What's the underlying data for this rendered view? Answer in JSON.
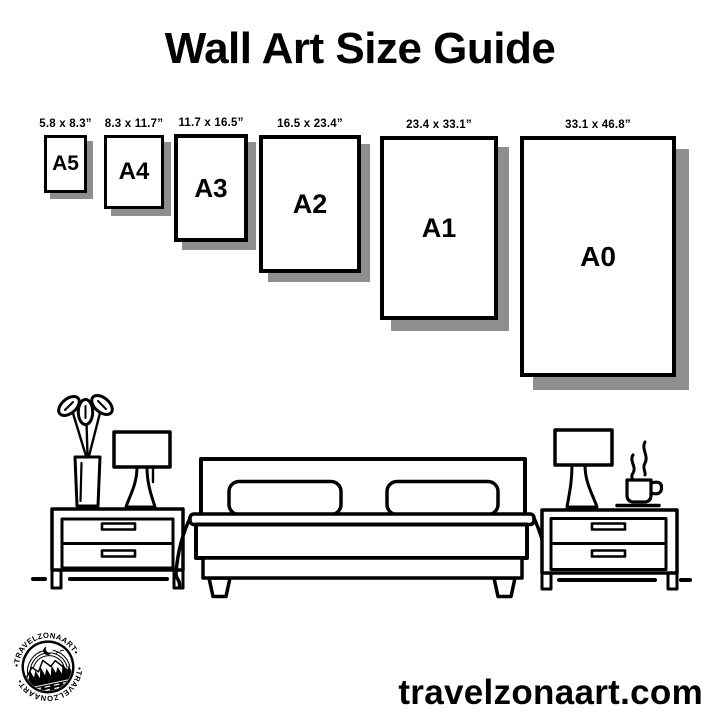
{
  "title": "Wall Art Size Guide",
  "size_guide": {
    "sizes": [
      {
        "label": "A5",
        "dimensions": "5.8 x 8.3”"
      },
      {
        "label": "A4",
        "dimensions": "8.3 x 11.7”"
      },
      {
        "label": "A3",
        "dimensions": "11.7 x 16.5”"
      },
      {
        "label": "A2",
        "dimensions": "16.5 x 23.4”"
      },
      {
        "label": "A1",
        "dimensions": "23.4 x 33.1”"
      },
      {
        "label": "A0",
        "dimensions": "33.1 x 46.8”"
      }
    ]
  },
  "illustration": {
    "elements": [
      "vase-with-leaves",
      "table-lamp",
      "nightstand",
      "double-bed-with-pillows",
      "table-lamp",
      "coffee-cup",
      "nightstand"
    ]
  },
  "footer": {
    "website": "travelzonaart.com",
    "logo": {
      "arc_text_top": "•TRAVELZONAART•",
      "arc_text_bottom": "•TRAVELZONAART•"
    }
  },
  "colors": {
    "ink": "#000000",
    "shadow": "#8e8e8e",
    "background": "#ffffff"
  }
}
